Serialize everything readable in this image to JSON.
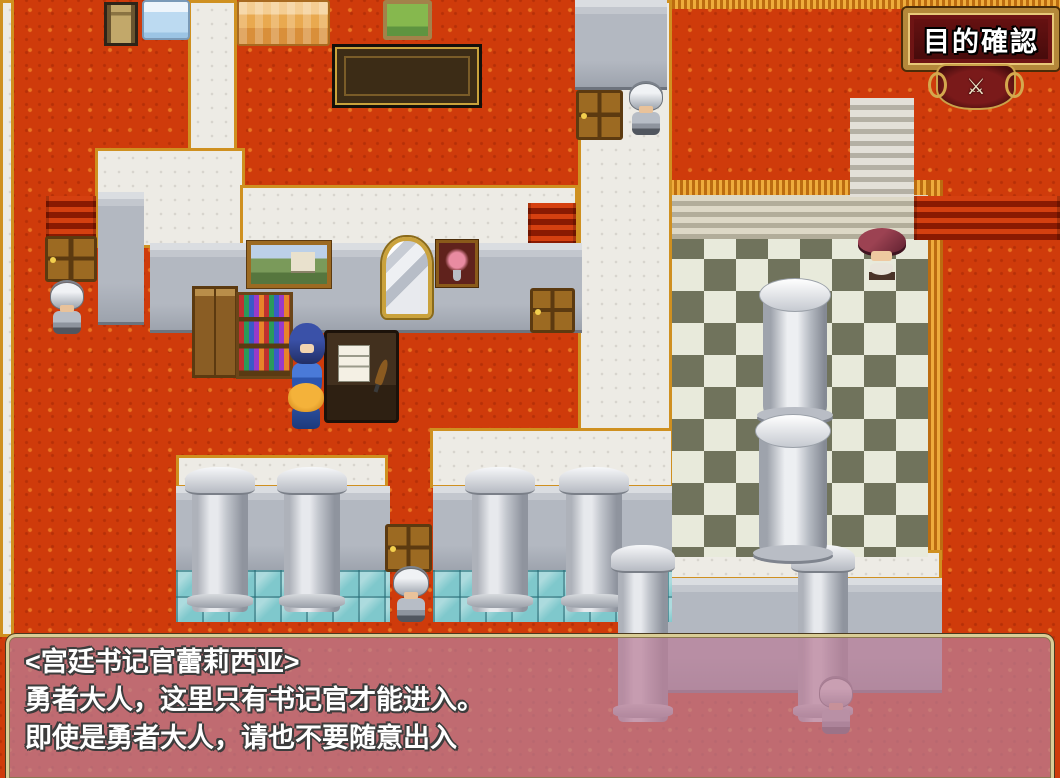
{
  "hud": {
    "objective_button": {
      "label": "目的確認",
      "emblem_icon": "royal-crest",
      "emblem_glyph": "⚔"
    }
  },
  "dialogue": {
    "speaker": "宫廷书记官蕾莉西亚",
    "lines": [
      "<宫廷书记官蕾莉西亚>",
      "勇者大人，这里只有书记官才能进入。",
      "即使是勇者大人，请也不要随意出入"
    ]
  },
  "colors": {
    "carpet": "#cf3b0b",
    "carpet_trim": "#de8f1e",
    "wall_top": "#edebe5",
    "wall_face": "#b3b8c1",
    "checker_dark": "#70735c",
    "checker_light": "#e8eadb",
    "teal_tile": "#7fc8cc",
    "dialog_fill": "rgba(186,126,152,0.72)",
    "dialog_border": "#d9cd96",
    "frame_gold": "#b4883a",
    "frame_red": "#5a1010"
  },
  "scene": {
    "characters": [
      {
        "name": "court-scribe-lelisia",
        "desc": "blue-haired girl facing down"
      },
      {
        "name": "hero",
        "desc": "blonde hero facing up toward scribe"
      },
      {
        "name": "guard-west"
      },
      {
        "name": "guard-north"
      },
      {
        "name": "guard-south"
      },
      {
        "name": "guard-behind-dialog"
      },
      {
        "name": "noble-with-red-hat"
      }
    ],
    "furniture": [
      "tan-chair",
      "blue-bed",
      "orange-bed",
      "green-chair",
      "long-table",
      "castle-painting",
      "wall-mirror",
      "rose-painting",
      "wooden-cabinet",
      "bookshelf",
      "writing-desk"
    ],
    "doors": [
      "west-door",
      "north-door",
      "center-door",
      "south-door"
    ],
    "structures": [
      "checkered-hall",
      "stone-pillars",
      "marble-columns",
      "red-stairs",
      "gray-steps",
      "teal-glass-tiles"
    ]
  }
}
